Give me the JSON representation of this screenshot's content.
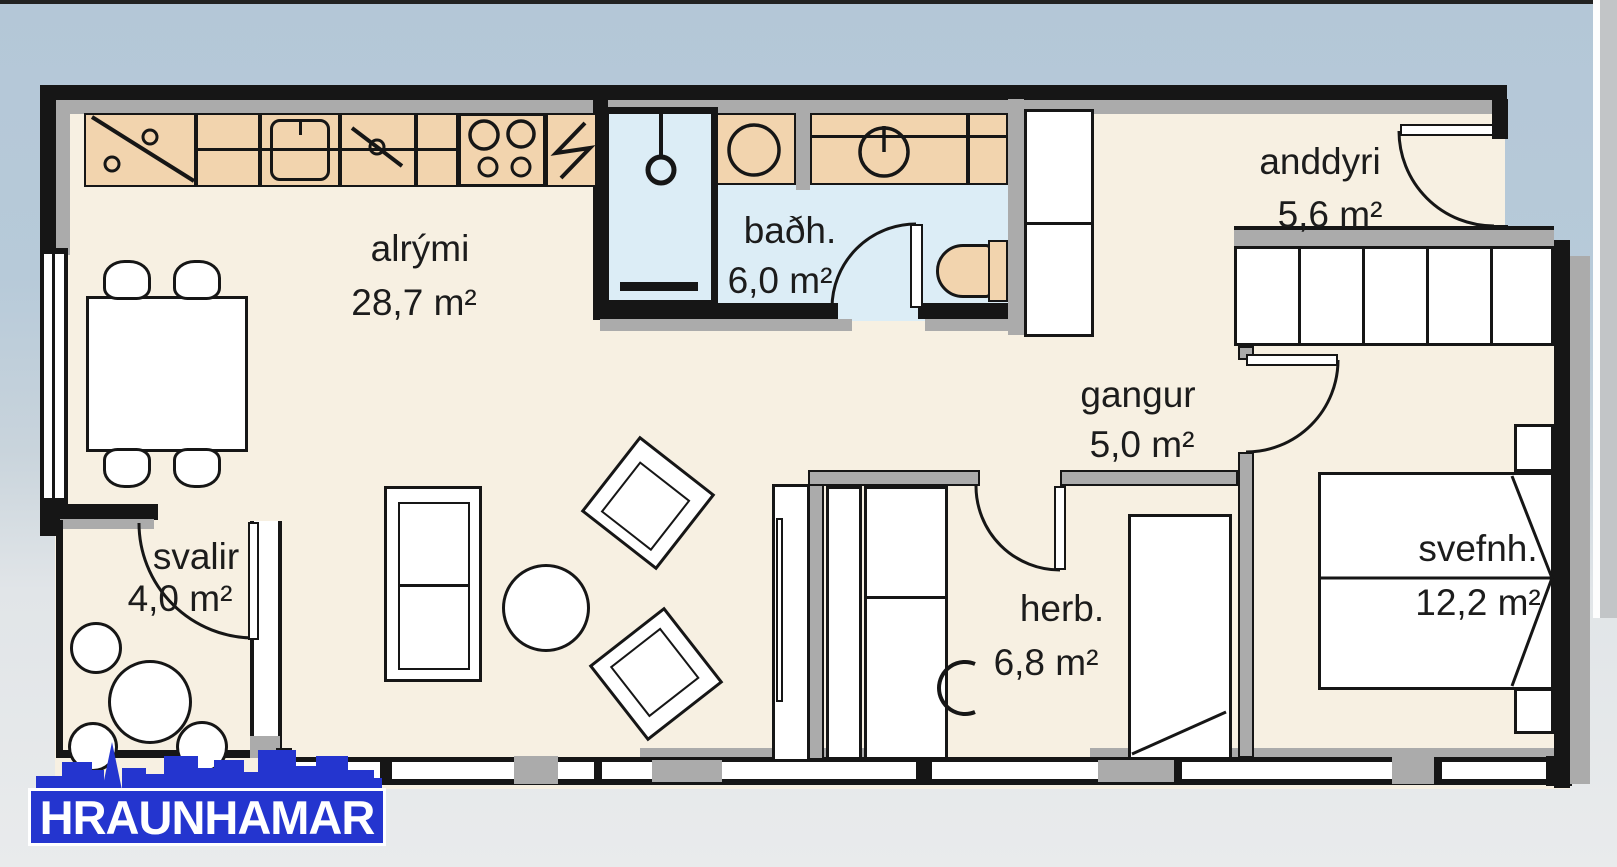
{
  "logo": {
    "text": "HRAUNHAMAR",
    "color": "#2435cf"
  },
  "rooms": [
    {
      "id": "alrymi",
      "label": "alrými",
      "area": "28,7 m²"
    },
    {
      "id": "badh",
      "label": "baðh.",
      "area": "6,0 m²"
    },
    {
      "id": "anddyri",
      "label": "anddyri",
      "area": "5,6 m²"
    },
    {
      "id": "gangur",
      "label": "gangur",
      "area": "5,0 m²"
    },
    {
      "id": "svalir",
      "label": "svalir",
      "area": "4,0 m²"
    },
    {
      "id": "herb",
      "label": "herb.",
      "area": "6,8 m²"
    },
    {
      "id": "svefnh",
      "label": "svefnh.",
      "area": "12,2 m²"
    }
  ],
  "colors": {
    "sky_background": "#b4c7d7",
    "ground_background": "#e9ebec",
    "floor": "#f7f0e2",
    "bathroom_floor": "#dcedf6",
    "cabinet_tan": "#f2d4ae",
    "wall_black": "#161616",
    "wall_gray": "#ababab",
    "logo_blue": "#2435cf"
  }
}
